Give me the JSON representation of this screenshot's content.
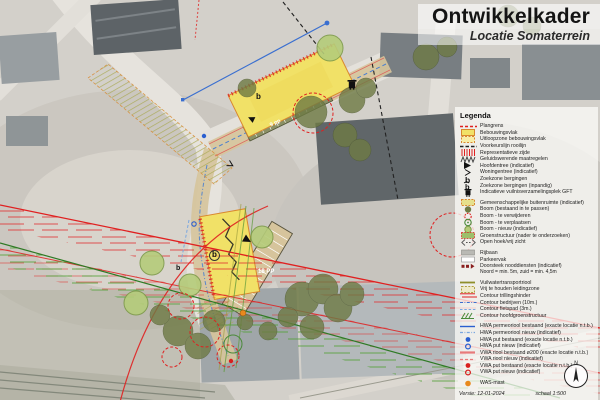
{
  "title": {
    "main": "Ontwikkelkader",
    "subtitle": "Locatie Somaterrein"
  },
  "legend": {
    "heading": "Legenda",
    "groups": [
      {
        "items": [
          {
            "symbol": "plangrens",
            "label": "Plangrens"
          },
          {
            "symbol": "bebouwingsvlak",
            "label": "Bebouwingsvlak"
          },
          {
            "symbol": "uitloopzone-bebouwingsvlak",
            "label": "Uitloopzone bebouwingsvlak"
          },
          {
            "symbol": "voorkeurslijn-rooilijn",
            "label": "Voorkeurslijn rooilijn"
          },
          {
            "symbol": "representatieve-zijde",
            "label": "Representatieve zijde"
          },
          {
            "symbol": "geluidswerende-maatregelen",
            "label": "Geluidswerende maatregelen"
          },
          {
            "symbol": "hoofdentree",
            "label": "Hoofdentree (indicatief)"
          },
          {
            "symbol": "woningentree",
            "label": "Woningentree (indicatief)"
          },
          {
            "symbol": "zoekzone-bergingen",
            "label": "Zoekzone bergingen"
          },
          {
            "symbol": "zoekzone-bergingen-inpandig",
            "label": "Zoekzone bergingen (inpandig)"
          },
          {
            "symbol": "vuilnisverzamelingsplek-gft",
            "label": "Indicatieve vuilnisverzamelingsplek GFT"
          }
        ]
      },
      {
        "items": [
          {
            "symbol": "gemeenschappelijke-buitenruimte",
            "label": "Gemeenschappelijke buitenruimte (indicatief)"
          },
          {
            "symbol": "boom-bestaand",
            "label": "Boom (bestaand in te passen)"
          },
          {
            "symbol": "boom-te-verwijderen",
            "label": "Boom - te verwijderen"
          },
          {
            "symbol": "boom-te-verplaatsen",
            "label": "Boom - te verplaatsen"
          },
          {
            "symbol": "boom-nieuw",
            "label": "Boom - nieuw (indicatief)"
          },
          {
            "symbol": "groenstructuur",
            "label": "Groenstructuur (nader te onderzoeken)"
          },
          {
            "symbol": "open-hoek-vrij-zicht",
            "label": "Open hoek/vrij zicht"
          }
        ]
      },
      {
        "items": [
          {
            "symbol": "rijbaan",
            "label": "Rijbaan"
          },
          {
            "symbol": "parkeervak",
            "label": "Parkeervak"
          },
          {
            "symbol": "doorsteek-nooddiensten",
            "label": "Doorsteek nooddiensten (indicatief)",
            "note": "Noord = min. 5m, zuid = min. 4,5m"
          }
        ]
      },
      {
        "items": [
          {
            "symbol": "vuilwatertransportriool",
            "label": "Vuilwatertransportriool"
          },
          {
            "symbol": "vrij-te-houden-leidingzone",
            "label": "Vrij te houden leidingzone"
          },
          {
            "symbol": "contour-trillingshinder",
            "label": "Contour trillingshinder"
          },
          {
            "symbol": "contour-bedrijven",
            "label": "Contour bedrijven (10m.)"
          },
          {
            "symbol": "contour-fietspad",
            "label": "Contour fietspad (3m.)"
          },
          {
            "symbol": "contour-hoofdgroenstructuur",
            "label": "Contour hoofdgroenstructuur"
          }
        ]
      },
      {
        "items": [
          {
            "symbol": "hwa-riool-bestaand",
            "label": "HWA permeoriool bestaand (exacte locatie n.t.b.)"
          },
          {
            "symbol": "hwa-riool-nieuw",
            "label": "HWA permeoriool nieuw (indicatief)"
          },
          {
            "symbol": "hwa-put-bestaand",
            "label": "HWA put bestaand (exacte locatie n.t.b.)"
          },
          {
            "symbol": "hwa-put-nieuw",
            "label": "HWA put nieuw (indicatief)"
          },
          {
            "symbol": "vwa-riool-bestaand",
            "label": "VWA riool bestaand ø200 (exacte locatie n.t.b.)"
          },
          {
            "symbol": "vwa-riool-nieuw",
            "label": "VWA riool nieuw (indicatief)"
          },
          {
            "symbol": "vwa-put-bestaand",
            "label": "VWA put bestaand (exacte locatie n.t.b.)"
          },
          {
            "symbol": "vwa-put-nieuw",
            "label": "VWA put nieuw (indicatief)"
          }
        ]
      },
      {
        "items": [
          {
            "symbol": "was-mast",
            "label": "WAS-mast"
          }
        ]
      }
    ]
  },
  "footer": {
    "version": "Versie: 12-01-2024",
    "scale": "schaal 1:500",
    "compass_letter": "N"
  },
  "map": {
    "labels": [
      {
        "text": "9 pp"
      },
      {
        "text": "18 PP"
      },
      {
        "text": "b"
      },
      {
        "text": "b"
      },
      {
        "text": "b"
      }
    ]
  },
  "colors": {
    "plan_red": "#e02020",
    "plan_yellow": "#f1e167",
    "plan_orange_border": "#d9882f",
    "road_tan": "#d6c49c",
    "tree_green": "#6e7a44",
    "tree_new_green": "#b5cc7a",
    "hwa_blue": "#2a5fd0",
    "vwa_red": "#d81f1f",
    "riool_olive": "#8f8f2a",
    "was_orange": "#e8891d",
    "groen_contour": "#2f7a25"
  }
}
